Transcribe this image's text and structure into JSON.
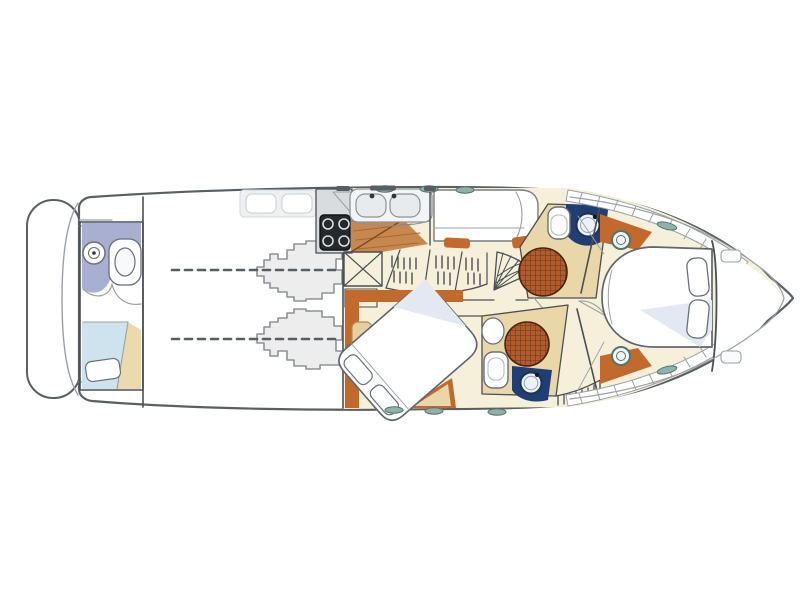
{
  "diagram": {
    "type": "yacht-interior-deck-plan",
    "orientation": "bow-right-stern-left",
    "features": [
      "swim-platform",
      "transom",
      "crew-cabin",
      "crew-toilet",
      "crew-washbasin",
      "crew-berth",
      "engine-room",
      "port-engine",
      "starboard-engine",
      "propeller-shaft-lines",
      "galley",
      "four-burner-stove",
      "double-sink",
      "wood-floor",
      "hanging-locker",
      "wardrobe-hanger-racks",
      "shelf-unit",
      "companionway-stairs",
      "guest-cabin-berth",
      "aft-cabin",
      "diagonal-double-bed",
      "bed-pillows",
      "seat-pouf",
      "port-head",
      "starboard-head",
      "circular-teak-shower",
      "toilet",
      "bidet",
      "vanity-washbasin",
      "master-cabin",
      "island-double-bed",
      "side-shelves",
      "deck-hatch",
      "portlight-ovals",
      "foredeck",
      "anchor-locker-bulkhead",
      "cockpit-seats"
    ]
  },
  "palette": {
    "background": "#ffffff",
    "hull_outline": "#5a5f63",
    "inner_line": "#9aa0a5",
    "wall": "#4a4f54",
    "floor_cream": "#f6f0da",
    "floor_tan": "#e9d6a9",
    "floor_wood": "#c8874e",
    "wood_line": "#a56a34",
    "trim_orange": "#c26a2e",
    "counter_gray": "#d8dcdf",
    "engine_gray": "#ededee",
    "engine_outline": "#8d9297",
    "navy": "#1f3e74",
    "lavender": "#a9afd2",
    "pale_blue": "#cfe3ee",
    "bed_shadow": "#e2e9f3",
    "shower_base": "#b05c2f",
    "shower_grid": "#6e3413",
    "teal_oval": "#8fb0ab",
    "teal_oval_outline": "#51756f",
    "stove_black": "#26292c",
    "fixture_outline": "#6a7076",
    "shaft_dash": "#585d61",
    "seat_gray": "#eef0f2"
  }
}
